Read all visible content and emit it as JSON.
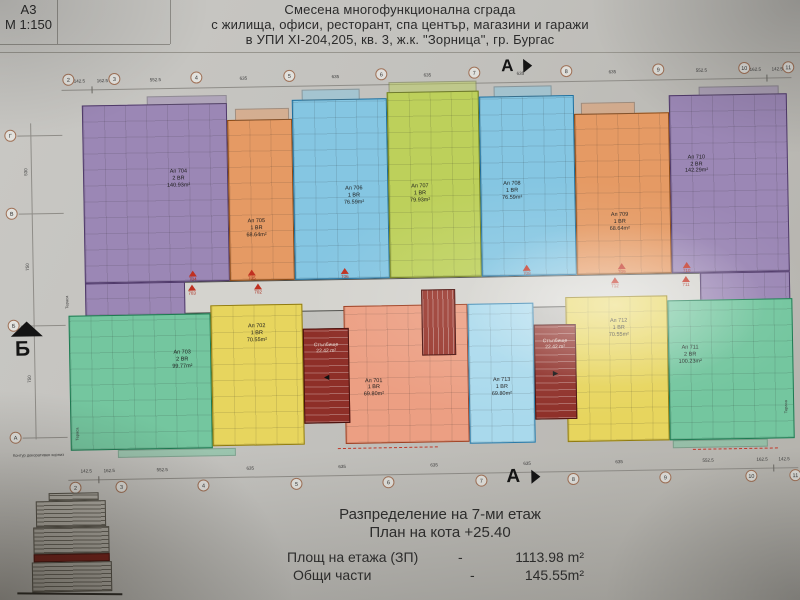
{
  "sheet": {
    "code": "А3",
    "scale": "М 1:150"
  },
  "title": {
    "line1": "Смесена многофункционална сграда",
    "line2": "с жилища, офиси, ресторант, спа център, магазини и гаражи",
    "line3": "в УПИ XI-204,205, кв. 3, ж.к. \"Зорница\", гр. Бургас"
  },
  "axes": {
    "top": {
      "circles": [
        "2",
        "3",
        "4",
        "5",
        "6",
        "7",
        "8",
        "9",
        "10",
        "11"
      ],
      "dims": [
        "142.5",
        "162.5",
        "552.5",
        "635",
        "635",
        "635",
        "635",
        "635",
        "552.5",
        "162.5",
        "142.5"
      ],
      "marker": "А"
    },
    "bottom": {
      "circles": [
        "2",
        "3",
        "4",
        "5",
        "6",
        "7",
        "8",
        "9",
        "10",
        "11"
      ],
      "dims": [
        "142.5",
        "162.5",
        "552.5",
        "635",
        "635",
        "635",
        "635",
        "635",
        "552.5",
        "162.5",
        "142.5"
      ],
      "marker": "А"
    },
    "left": {
      "circles": [
        "Г",
        "В",
        "Б",
        "А"
      ],
      "dims": [
        "530",
        "750",
        "750"
      ],
      "marker": "Б"
    }
  },
  "plan": {
    "apartments": [
      {
        "name": "Ап 704",
        "type": "2 BR",
        "area": "140.93m²",
        "fill": "#9b87b5",
        "wall": "#503a6a"
      },
      {
        "name": "Ап 705",
        "type": "1 BR",
        "area": "68.64m²",
        "fill": "#e59a64",
        "wall": "#8a4a16"
      },
      {
        "name": "Ап 706",
        "type": "1 BR",
        "area": "76.59m²",
        "fill": "#85c6e2",
        "wall": "#1f6e9c"
      },
      {
        "name": "Ап 707",
        "type": "1 BR",
        "area": "79.93m²",
        "fill": "#bdd05b",
        "wall": "#6e7c1a"
      },
      {
        "name": "Ап 708",
        "type": "1 BR",
        "area": "76.59m²",
        "fill": "#85c6e2",
        "wall": "#1f6e9c"
      },
      {
        "name": "Ап 709",
        "type": "1 BR",
        "area": "68.64m²",
        "fill": "#e59a64",
        "wall": "#8a4a16"
      },
      {
        "name": "Ап 710",
        "type": "2 BR",
        "area": "142.29m²",
        "fill": "#9b87b5",
        "wall": "#503a6a"
      },
      {
        "name": "Ап 703",
        "type": "2 BR",
        "area": "99.77m²",
        "fill": "#74c69f",
        "wall": "#1e7a52"
      },
      {
        "name": "Ап 702",
        "type": "1 BR",
        "area": "70.55m²",
        "fill": "#e7d55e",
        "wall": "#8f7a10"
      },
      {
        "name": "Ап 701",
        "type": "1 BR",
        "area": "69.80m²",
        "fill": "#ec9f83",
        "wall": "#9c3f22"
      },
      {
        "name": "Ап 713",
        "type": "1 BR",
        "area": "69.80m²",
        "fill": "#a9d9ec",
        "wall": "#2a7aa8"
      },
      {
        "name": "Ап 712",
        "type": "1 BR",
        "area": "70.55m²",
        "fill": "#e7d55e",
        "wall": "#8f7a10"
      },
      {
        "name": "Ап 711",
        "type": "2 BR",
        "area": "100.23m²",
        "fill": "#74c69f",
        "wall": "#1e7a52"
      }
    ],
    "stair_label": {
      "name": "Стълбище",
      "area": "22.42 m²"
    },
    "entrances": {
      "top": [
        "704",
        "705",
        "706",
        "708",
        "709",
        "710"
      ],
      "bottom": [
        "703",
        "702",
        "712",
        "711"
      ]
    },
    "terrace_label": "Тераса",
    "cornice_note": "Контур декоративен корниз"
  },
  "footer": {
    "line1": "Разпределение на 7-ми  етаж",
    "line2": "План на кота  +25.40",
    "area_label": "Площ на етажа (ЗП)",
    "area_sep": "-",
    "area_value": "1113.98 m²",
    "common_label": "Общи части",
    "common_sep": "-",
    "common_value": "145.55m²"
  },
  "legend_partial": {
    "line1": "Ателиет",
    "line2": "1 Б",
    "line3": "2 Б"
  },
  "colors": {
    "entrance_marker": "#c03020",
    "stair_fill": "#8e2f28",
    "paper": "#c2c1bd"
  }
}
